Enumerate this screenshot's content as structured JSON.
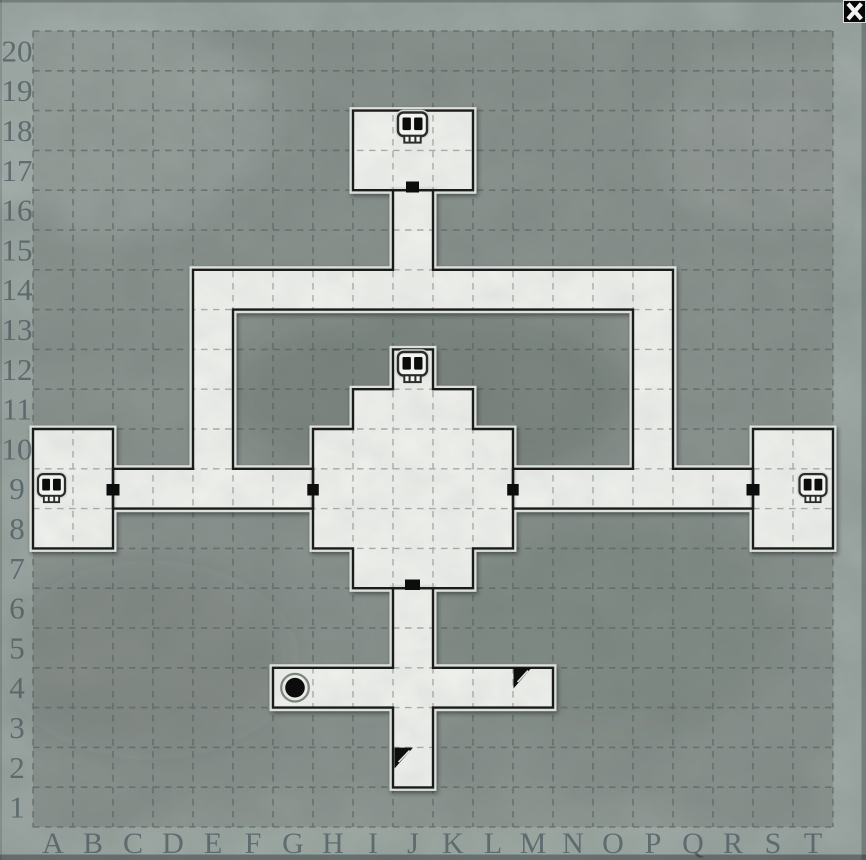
{
  "window": {
    "close_button": {
      "icon": "x-close"
    }
  },
  "grid": {
    "columns": [
      "A",
      "B",
      "C",
      "D",
      "E",
      "F",
      "G",
      "H",
      "I",
      "J",
      "K",
      "L",
      "M",
      "N",
      "O",
      "P",
      "Q",
      "R",
      "S",
      "T"
    ],
    "rows": [
      "1",
      "2",
      "3",
      "4",
      "5",
      "6",
      "7",
      "8",
      "9",
      "10",
      "11",
      "12",
      "13",
      "14",
      "15",
      "16",
      "17",
      "18",
      "19",
      "20"
    ],
    "origin_x": 33,
    "origin_y": 31,
    "cell_w": 40,
    "cell_h": 39.8
  },
  "colors": {
    "background": "#9da7a3",
    "map_field": "#8b938f",
    "floor": "#edefeb",
    "wall": "#1b1b1b",
    "door": "#0d0d0d",
    "grid_background_lines": "#525d5c",
    "grid_floor_lines": "#a2a8a5",
    "label_text": "#3f4f56"
  },
  "map": {
    "floors": [
      {
        "name": "north-room",
        "cells": "I17-K18",
        "points": [
          [
            353,
            110.6
          ],
          [
            473,
            110.6
          ],
          [
            473,
            190.2
          ],
          [
            353,
            190.2
          ]
        ]
      },
      {
        "name": "loop-corridor",
        "cells": "J15-J16 + E9-P14 loop + C9-G9 + M9-R9",
        "points": [
          [
            393,
            190.2
          ],
          [
            433,
            190.2
          ],
          [
            433,
            269.8
          ],
          [
            673,
            269.8
          ],
          [
            673,
            468.8
          ],
          [
            753,
            468.8
          ],
          [
            753,
            508.6
          ],
          [
            513,
            508.6
          ],
          [
            513,
            468.8
          ],
          [
            633,
            468.8
          ],
          [
            633,
            309.6
          ],
          [
            233,
            309.6
          ],
          [
            233,
            468.8
          ],
          [
            313,
            468.8
          ],
          [
            313,
            508.6
          ],
          [
            113,
            508.6
          ],
          [
            113,
            468.8
          ],
          [
            193,
            468.8
          ],
          [
            193,
            269.8
          ],
          [
            393,
            269.8
          ]
        ]
      },
      {
        "name": "central-room",
        "cells": "H7-L11 + alcove J12",
        "points": [
          [
            393,
            349.4
          ],
          [
            433,
            349.4
          ],
          [
            433,
            389.2
          ],
          [
            473,
            389.2
          ],
          [
            473,
            429
          ],
          [
            513,
            429
          ],
          [
            513,
            548.4
          ],
          [
            473,
            548.4
          ],
          [
            473,
            588.2
          ],
          [
            353,
            588.2
          ],
          [
            353,
            548.4
          ],
          [
            313,
            548.4
          ],
          [
            313,
            429
          ],
          [
            353,
            429
          ],
          [
            353,
            389.2
          ],
          [
            393,
            389.2
          ]
        ]
      },
      {
        "name": "west-room",
        "cells": "A8-B10",
        "points": [
          [
            33,
            429
          ],
          [
            113,
            429
          ],
          [
            113,
            548.4
          ],
          [
            33,
            548.4
          ]
        ]
      },
      {
        "name": "east-room",
        "cells": "S8-T10",
        "points": [
          [
            753,
            429
          ],
          [
            833,
            429
          ],
          [
            833,
            548.4
          ],
          [
            753,
            548.4
          ]
        ]
      },
      {
        "name": "south-corridor",
        "cells": "J2-J6 + G4-M4",
        "points": [
          [
            393,
            588.2
          ],
          [
            433,
            588.2
          ],
          [
            433,
            667.8
          ],
          [
            553,
            667.8
          ],
          [
            553,
            707.6
          ],
          [
            433,
            707.6
          ],
          [
            433,
            787.4
          ],
          [
            393,
            787.4
          ],
          [
            393,
            707.6
          ],
          [
            273,
            707.6
          ],
          [
            273,
            667.8
          ],
          [
            393,
            667.8
          ]
        ]
      }
    ],
    "doors": [
      {
        "cell": "J17-south",
        "x": 406,
        "y": 181.5,
        "w": 13,
        "h": 11
      },
      {
        "cell": "B9-east",
        "x": 106.5,
        "y": 484,
        "w": 13,
        "h": 11.5
      },
      {
        "cell": "H9-west",
        "x": 307.3,
        "y": 484,
        "w": 11.5,
        "h": 11.5
      },
      {
        "cell": "L9-east",
        "x": 507.2,
        "y": 484,
        "w": 11.5,
        "h": 11.5
      },
      {
        "cell": "S9-west",
        "x": 746.5,
        "y": 484,
        "w": 13,
        "h": 11.5
      },
      {
        "cell": "J7-south",
        "x": 405,
        "y": 579.5,
        "w": 15,
        "h": 10.5
      }
    ],
    "markers": [
      {
        "type": "skull",
        "cell": "J18",
        "x": 412.5,
        "y": 129,
        "scale": 1
      },
      {
        "type": "skull",
        "cell": "J12",
        "x": 412.5,
        "y": 368.5,
        "scale": 1
      },
      {
        "type": "skull",
        "cell": "A9",
        "x": 51.5,
        "y": 489.5,
        "scale": 0.93
      },
      {
        "type": "skull",
        "cell": "T9",
        "x": 813,
        "y": 489.5,
        "scale": 0.93
      },
      {
        "type": "well",
        "cell": "G4",
        "x": 295,
        "y": 687.7
      },
      {
        "type": "stairs",
        "cell": "M4",
        "points": [
          [
            513.5,
            667.8
          ],
          [
            531.5,
            667.8
          ],
          [
            513.5,
            688.5
          ]
        ],
        "stripe": [
          [
            517.5,
            682
          ],
          [
            528,
            670.5
          ]
        ]
      },
      {
        "type": "stairs",
        "cell": "J2",
        "points": [
          [
            394.5,
            747.6
          ],
          [
            413,
            747.6
          ],
          [
            394.5,
            768.5
          ]
        ],
        "stripe": [
          [
            398.5,
            762
          ],
          [
            409.5,
            750.5
          ]
        ]
      }
    ]
  }
}
